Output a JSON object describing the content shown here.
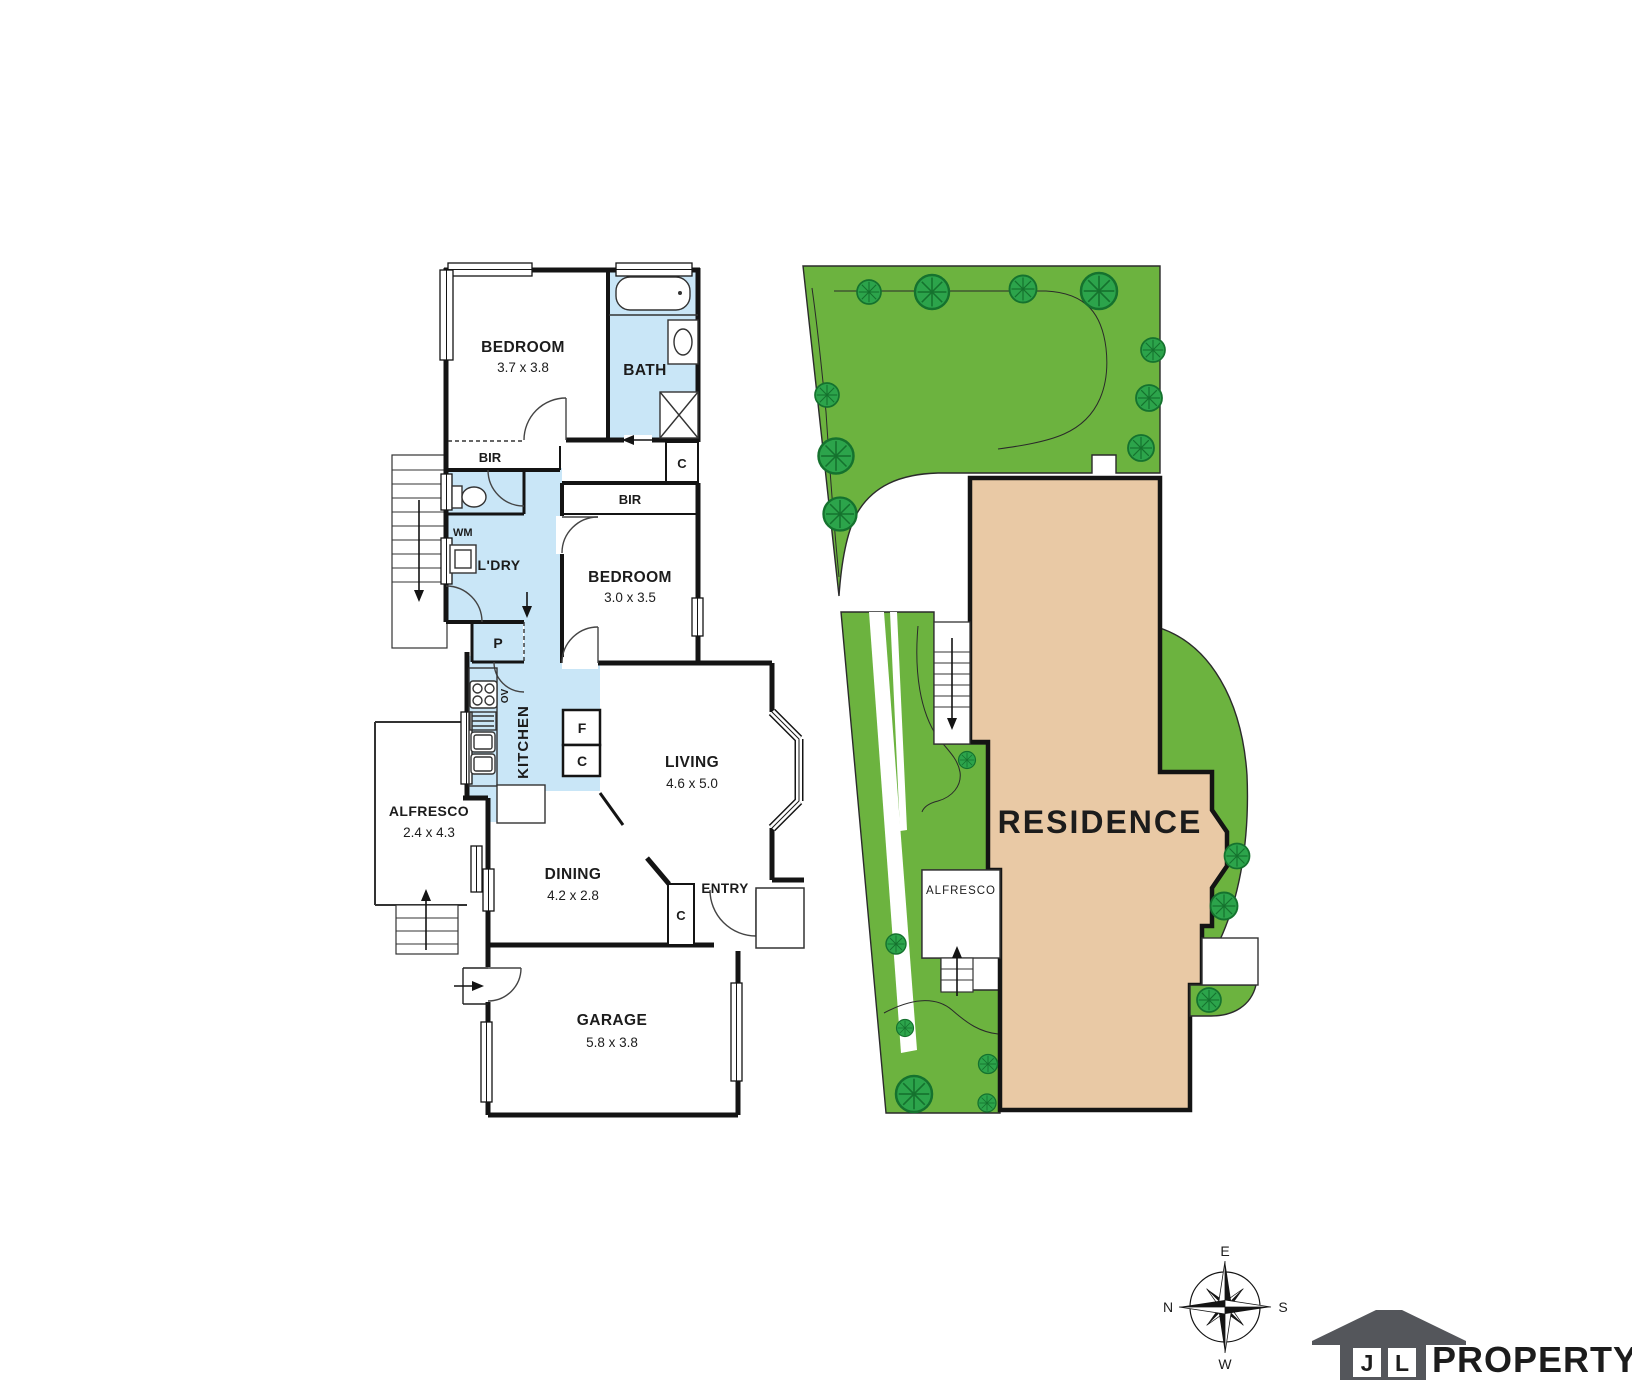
{
  "floor_plan": {
    "bedroom1": {
      "name": "BEDROOM",
      "dims": "3.7 x 3.8"
    },
    "bath": {
      "name": "BATH"
    },
    "bir_top": "BIR",
    "closet_top": "C",
    "wm": "WM",
    "laundry": "L'DRY",
    "bir_mid": "BIR",
    "bedroom2": {
      "name": "BEDROOM",
      "dims": "3.0 x 3.5"
    },
    "pantry": "P",
    "oven": "OV",
    "kitchen": "KITCHEN",
    "fridge": "F",
    "cupboard": "C",
    "living": {
      "name": "LIVING",
      "dims": "4.6 x 5.0"
    },
    "alfresco": {
      "name": "ALFRESCO",
      "dims": "2.4 x 4.3"
    },
    "dining": {
      "name": "DINING",
      "dims": "4.2 x 2.8"
    },
    "entry": {
      "name": "ENTRY",
      "closet": "C"
    },
    "garage": {
      "name": "GARAGE",
      "dims": "5.8 x 3.8"
    }
  },
  "site_plan": {
    "residence": "RESIDENCE",
    "alfresco": "ALFRESCO"
  },
  "compass": {
    "top": "E",
    "left": "N",
    "right": "S",
    "bottom": "W"
  },
  "logo": {
    "letter1": "J",
    "letter2": "L",
    "brand": "PROPERTY"
  },
  "colors": {
    "wet_area": "#c9e6f7",
    "garden": "#6cb33f",
    "tree": "#2ca44b",
    "residence_fill": "#e9c9a5",
    "wall": "#141414",
    "logo_gray": "#54565b",
    "brand_gray": "#6e6f72"
  }
}
